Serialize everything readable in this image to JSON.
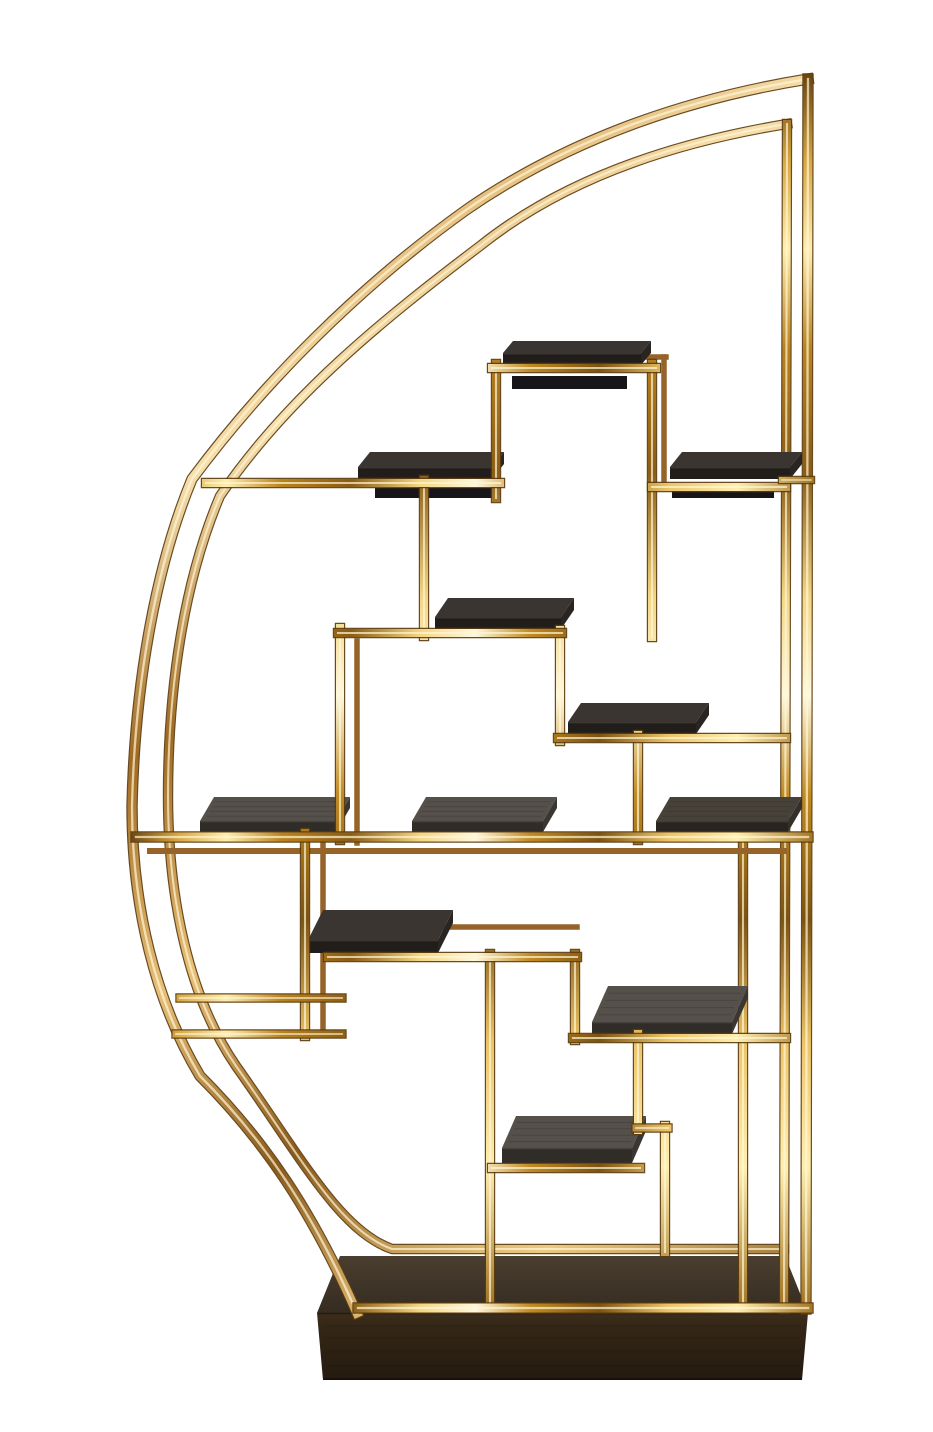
{
  "image": {
    "type": "product-photograph",
    "subject": "Half-moon polished brass etagere room divider with asymmetric geometric shelving, eleven dark oak display shelves and a dark wood plinth base, photographed on a white seamless background",
    "background": "#ffffff"
  },
  "structure": {
    "shelf_count": 11,
    "arc_count": 2,
    "frame_material": "polished brass tube",
    "shelf_material": "dark stained oak",
    "base_material": "dark walnut plinth"
  },
  "palette": {
    "background": "#ffffff",
    "brass_edge": "#5c3c0e",
    "brass_deep": "#6b450e",
    "brass_mid": "#c8922e",
    "brass_bright": "#ffeeb0",
    "brass_core": "#fff7d6",
    "brass_back": "#96642a",
    "shelf_dark_top": "#3a3531",
    "shelf_dark_front": "#201d1b",
    "shelf_dark_side": "#292522",
    "shelf_gray_top": "#555049",
    "shelf_gray_front": "#302c28",
    "shelf_gray_side": "#3a3631",
    "shelf_mid_top": "#474239",
    "shelf_mid_front": "#282420",
    "shelf_mid_side": "#332f2a",
    "shelf_underside": "#17151a",
    "base_top_light": "#4a3e30",
    "base_top_dark": "#352b20",
    "base_front_light": "#3c2d1c",
    "base_front_dark": "#241a0f",
    "base_grain": "#1c1208"
  }
}
